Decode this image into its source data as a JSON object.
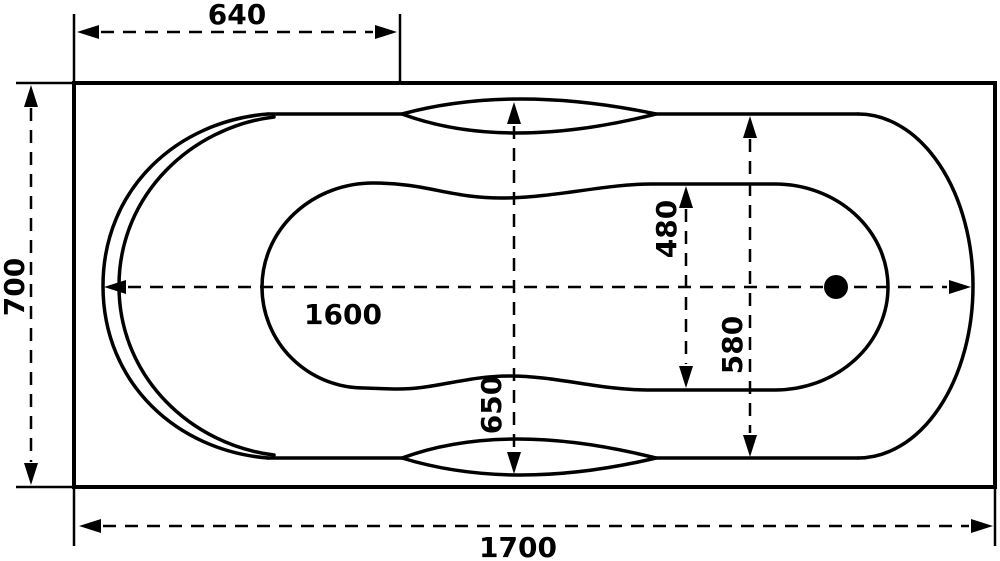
{
  "diagram": {
    "type": "bathtub-top-view-technical-drawing",
    "units": "mm",
    "colors": {
      "line": "#000000",
      "background": "#ffffff"
    },
    "dimensions": {
      "top_offset": "640",
      "overall_width": "700",
      "tub_length": "1600",
      "basin_width": "480",
      "rim_width": "580",
      "waist_width": "650",
      "overall_length": "1700"
    }
  }
}
